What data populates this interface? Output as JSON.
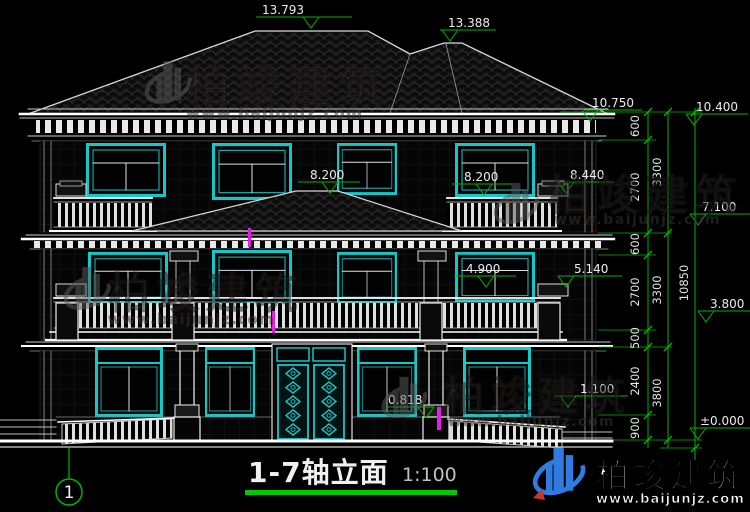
{
  "title": {
    "text": "1-7轴立面",
    "scale": "1:100"
  },
  "axis": {
    "bubble": "1"
  },
  "elevations": {
    "e13793": "13.793",
    "e13388": "13.388",
    "e10750": "10.750",
    "e10400": "10.400",
    "e8200L": "8.200",
    "e8200R": "8.200",
    "e8440": "8.440",
    "e7100": "7.100",
    "e5140": "5.140",
    "e4900": "4.900",
    "e3800": "3.800",
    "e1100": "1.100",
    "e0818": "0.818",
    "e0000": "±0.000"
  },
  "dims": {
    "inner": [
      "600",
      "2700",
      "600",
      "2700",
      "500",
      "2400",
      "900"
    ],
    "mid": [
      "3300",
      "3300",
      "3800"
    ],
    "total": "10850"
  },
  "watermark": {
    "brand": "柏竣建筑",
    "url": "www.baijunjz.com"
  }
}
